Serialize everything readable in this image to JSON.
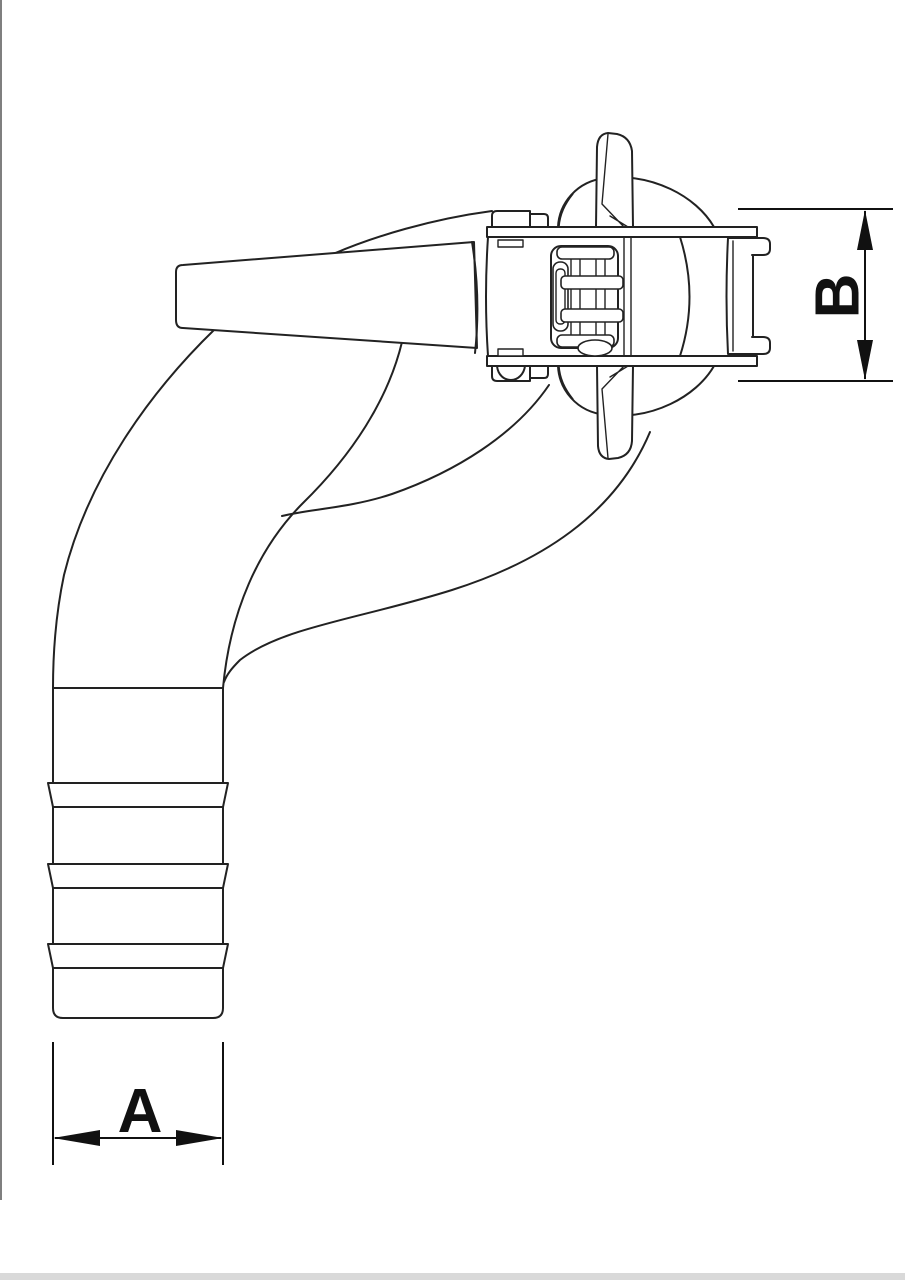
{
  "drawing": {
    "kind": "technical-line-drawing",
    "subject": "90-degree elbow hose coupling with barbed hose tail",
    "parts": [
      "coupling-head",
      "top-lug",
      "bottom-lug",
      "top-flange",
      "bottom-flange",
      "cam-latch",
      "seal-face-block",
      "seal-hooks",
      "tapered-neck",
      "elbow-90-bend",
      "hose-barb-tail",
      "barb-ring",
      "barb-ring",
      "barb-ring"
    ]
  },
  "annotations": {
    "dim_a": {
      "label": "A",
      "orientation": "horizontal"
    },
    "dim_b": {
      "label": "B",
      "orientation": "vertical"
    }
  },
  "style": {
    "background": "#ffffff",
    "line_color": "#222222",
    "label_color": "#111111",
    "left_border_color": "#555555",
    "bottom_strip_color": "#d9d9d9"
  }
}
